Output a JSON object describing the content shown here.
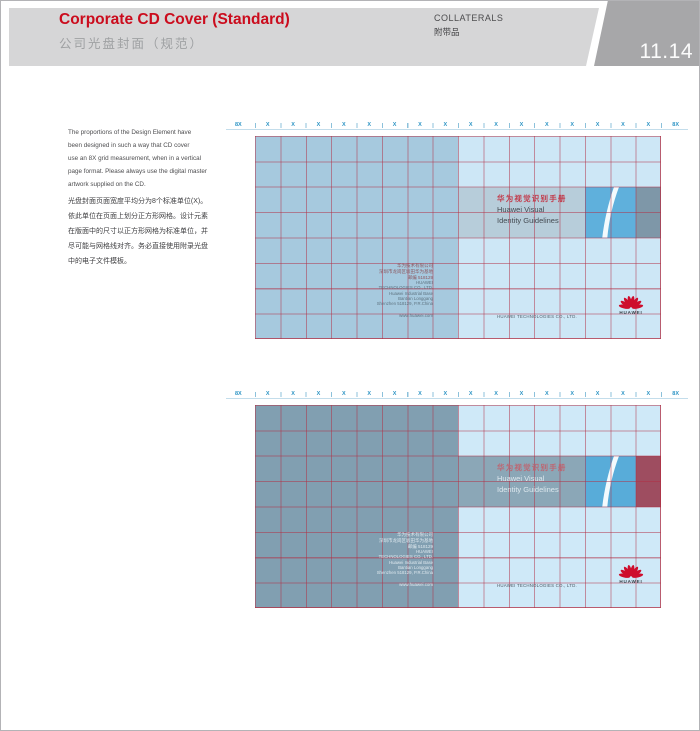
{
  "header": {
    "title": "Corporate CD Cover (Standard)",
    "subtitle": "公司光盘封面（规范）",
    "section_en": "COLLATERALS",
    "section_cn": "附带品",
    "page_number": "11.14"
  },
  "intro": {
    "en_lines": [
      "The proportions of the Design Element have",
      "been designed in such a way that CD cover",
      "use an 8X grid measurement, when in a vertical",
      "page format. Please always use the digital master",
      "artwork supplied on the CD."
    ],
    "cn_lines": [
      "光盘封面页面宽度平均分为8个标准单位(X)。",
      "依此单位在页面上划分正方形网格。设计元素",
      "在版面中的尺寸以正方形网格为标准单位，并",
      "尽可能与网格线对齐。务必直接使用附录光盘",
      "中的电子文件模板。"
    ]
  },
  "ruler": {
    "left_label": "8X",
    "right_label": "8X",
    "units": [
      "X",
      "X",
      "X",
      "X",
      "X",
      "X",
      "X",
      "X",
      "X",
      "X",
      "X",
      "X",
      "X",
      "X",
      "X",
      "X"
    ]
  },
  "cover": {
    "title_cn": "华为视觉识别手册",
    "title_en_line1": "Huawei Visual",
    "title_en_line2": "Identity Guidelines",
    "address_cn_lines": [
      "华为技术有限公司",
      "深圳市龙岗区坂田华为基地",
      "邮编 518129"
    ],
    "address_en_lines": [
      "HUAWEI",
      "TECHNOLOGIES CO., LTD.",
      "Huawei Industrial Base",
      "Bantian Longgang",
      "Shenzhen 518129, P.R.China"
    ],
    "website": "www.huawei.com",
    "company_line": "HUAWEI TECHNOLOGIES CO., LTD.",
    "logo_text": "HUAWEI"
  },
  "diagrams": [
    {
      "id": "cd-cover-grid-standard",
      "colors": {
        "left": "#a6c9de",
        "right": "#cde7f6",
        "band": "#b7cdda",
        "square": "#5fb0dc",
        "accent": "#7e97a8",
        "titleCn": "#c23b4b",
        "titleEn": "#454b52",
        "addrCn": "#8c565e",
        "addrEn": "#5e7380",
        "small": "#56626d"
      }
    },
    {
      "id": "cd-cover-grid-screened",
      "colors": {
        "left": "#819fb1",
        "right": "#cfe9f8",
        "band": "#8ba7b7",
        "square": "#58acd9",
        "accent": "#9e4d60",
        "titleCn": "#bd6672",
        "titleEn": "#dde8ee",
        "addrCn": "#dfe9ef",
        "addrEn": "#dfe9ef",
        "small": "#4e5a64"
      }
    }
  ],
  "palette": {
    "header_red": "#cb0c1d",
    "header_band_gray": "#d6d6d7",
    "page_num_gray": "#a7a7a9",
    "grid_line_red": "#b22d42",
    "ruler_blue": "#2f95c5",
    "logo_red": "#ce0e2d"
  }
}
